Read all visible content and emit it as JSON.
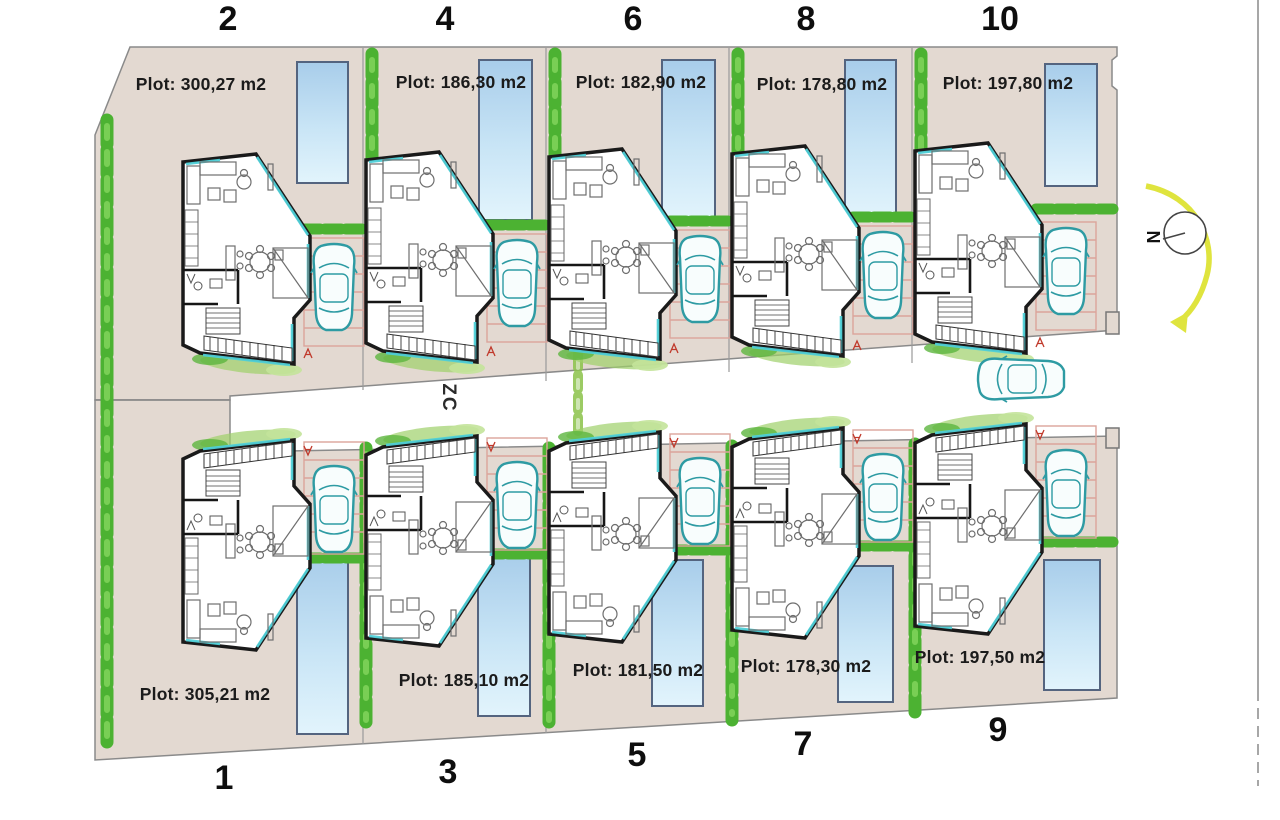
{
  "plots": [
    {
      "row": "top",
      "number": "2",
      "area_label": "Plot: 300,27 m2"
    },
    {
      "row": "top",
      "number": "4",
      "area_label": "Plot: 186,30 m2"
    },
    {
      "row": "top",
      "number": "6",
      "area_label": "Plot: 182,90 m2"
    },
    {
      "row": "top",
      "number": "8",
      "area_label": "Plot: 178,80 m2"
    },
    {
      "row": "top",
      "number": "10",
      "area_label": "Plot: 197,80 m2"
    },
    {
      "row": "bottom",
      "number": "1",
      "area_label": "Plot: 305,21 m2"
    },
    {
      "row": "bottom",
      "number": "3",
      "area_label": "Plot: 185,10 m2"
    },
    {
      "row": "bottom",
      "number": "5",
      "area_label": "Plot: 181,50 m2"
    },
    {
      "row": "bottom",
      "number": "7",
      "area_label": "Plot: 178,30 m2"
    },
    {
      "row": "bottom",
      "number": "9",
      "area_label": "Plot: 197,50 m2"
    }
  ],
  "street": {
    "label": "ZC"
  },
  "compass": {
    "label": "N"
  },
  "colors": {
    "plot_fill": "#e3d9d1",
    "plot_edge": "#8a8a8a",
    "hedge_green": "#4cb232",
    "hedge_light": "#79cf55",
    "pool_border": "#54647f",
    "pool_blue_top": "#a8cdea",
    "pool_blue_bottom": "#e2f4fc",
    "wall_black": "#1a1a1a",
    "glazing_cyan": "#4fd0d8",
    "car_teal": "#2e9ba3",
    "paver_pink": "#dba49b",
    "arrow_yellow": "#dfe43e",
    "mark_red": "#c0392b"
  }
}
